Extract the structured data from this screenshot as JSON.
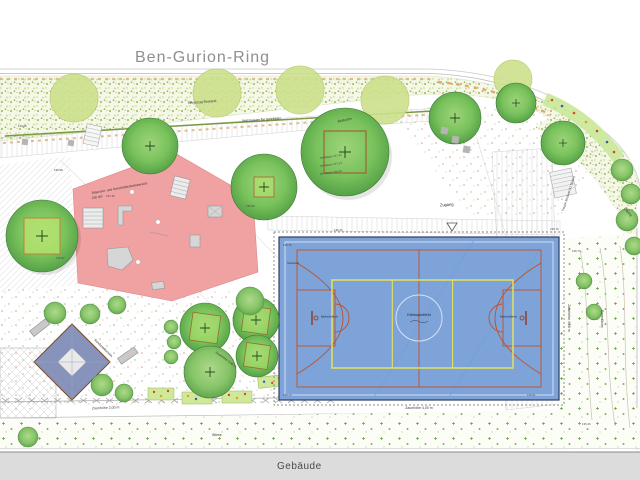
{
  "street": {
    "name": "Ben-Gurion-Ring"
  },
  "building": {
    "name": "Gebäude"
  },
  "play_area": {
    "title": "Balancier- und Geschicklichkeitsbereich",
    "area": "230 qm"
  },
  "sand_area": {
    "title": "Sandspielbereich"
  },
  "court": {
    "center_label": "Kleinspielfeld",
    "surface_label": "Spielfeld",
    "left_hoop": "Basketballkorb",
    "right_hoop": "Basketballkorb",
    "fence_left": "Zaunhöhe 4,00 m",
    "fence_right": "Zaunhöhe 4,00 m",
    "fence_bottom": "Zaunhöhe 4,00 m"
  },
  "labels": {
    "walkway": "Wegezug Bestand",
    "wall": "Stützmauer für Spielplatz",
    "access": "Zugang",
    "access_side": "Zugang",
    "stairs": "Treppe Bestand (11 Stufen)",
    "meadow": "Wiese",
    "lawn": "Rasenfläche",
    "fence_low": "Zaunhöhe 2,00 m",
    "fence_low2": "Zaunhöhe 2,00 m",
    "tree_species": "Blutbuche",
    "wall_top1": "OK Mauer 137.45",
    "wall_top2": "OK Mauer 137.15",
    "wall_top3": "OK Mauer 136.95"
  },
  "elevations": [
    "136.06",
    "136.98",
    "137.46",
    "136.26",
    "136.43",
    "135.74",
    "136.74",
    "135.76",
    "136.27",
    "135.26",
    "136.41",
    "136.13"
  ],
  "colors": {
    "court_blue": "#7ea3d8",
    "court_line_orange": "#c05028",
    "court_line_yellow": "#e3e35a",
    "play_pink": "#f0a1a1",
    "tree_dark": "#55a848",
    "tree_light": "#cde08c",
    "building_gray": "#dcdcdc",
    "street_text_gray": "#8f8f8f"
  }
}
